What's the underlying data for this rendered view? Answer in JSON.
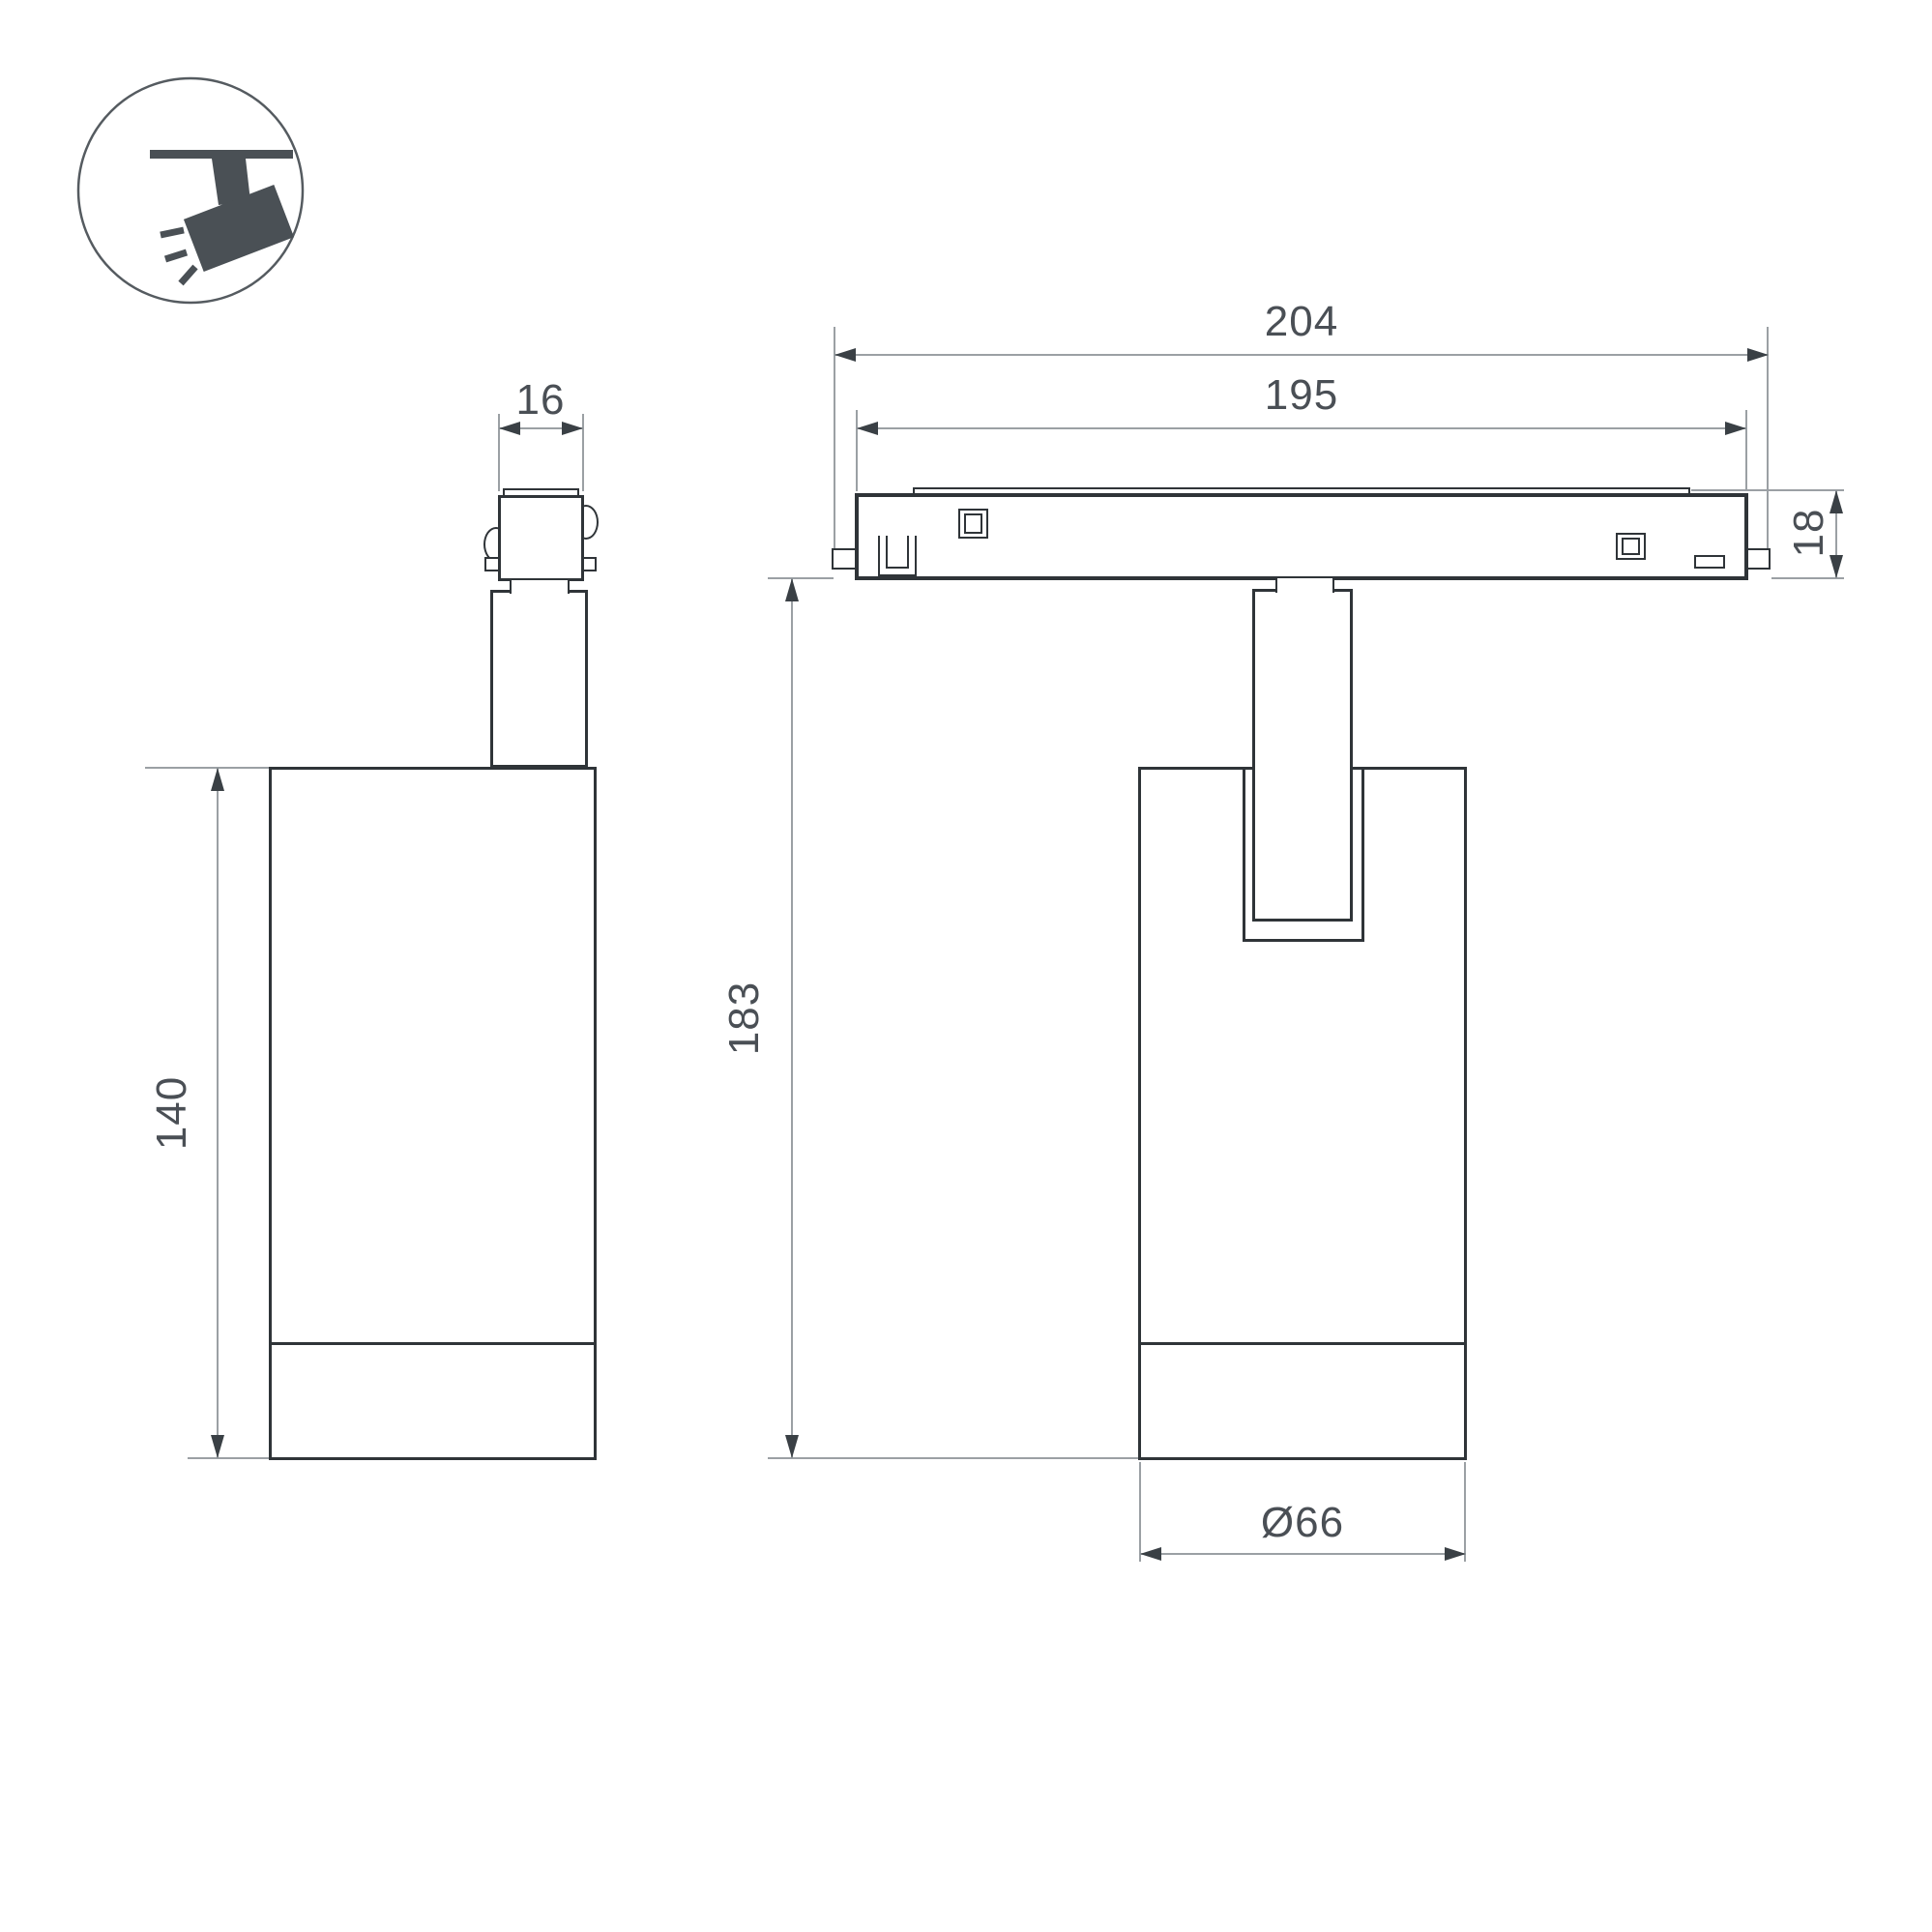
{
  "title": "Track spotlight dimensional drawing",
  "icon": {
    "name": "track-spotlight-icon"
  },
  "dimensions": {
    "adapter_width": {
      "label": "16"
    },
    "body_height_side": {
      "label": "140"
    },
    "track_length_total": {
      "label": "204"
    },
    "track_length_inner": {
      "label": "195"
    },
    "track_height": {
      "label": "18"
    },
    "fixture_height": {
      "label": "183"
    },
    "body_diameter": {
      "label": "Ø66"
    }
  },
  "colors": {
    "background": "#ffffff",
    "part_line": "#2f3438",
    "dimension_line": "#9ba0a4",
    "arrow": "#3a4045",
    "text": "#4a4f55",
    "icon": "#4a5055"
  }
}
